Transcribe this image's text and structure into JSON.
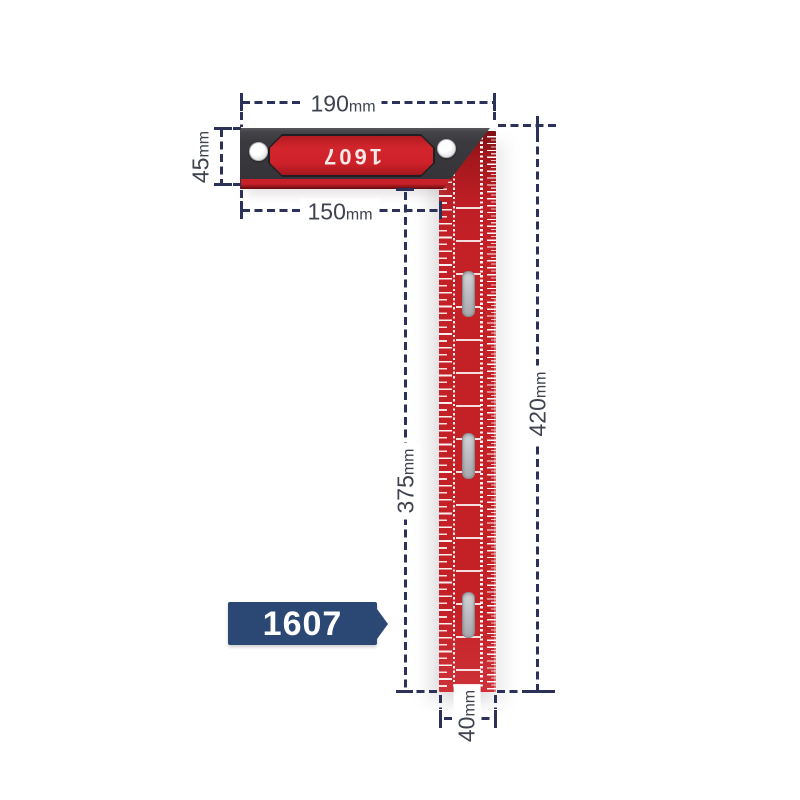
{
  "product": {
    "handle_label": "1607",
    "badge_label": "1607"
  },
  "dimensions": {
    "top_width": {
      "value": "190",
      "unit": "mm"
    },
    "handle_height": {
      "value": "45",
      "unit": "mm"
    },
    "handle_length": {
      "value": "150",
      "unit": "mm"
    },
    "blade_length": {
      "value": "375",
      "unit": "mm"
    },
    "total_length": {
      "value": "420",
      "unit": "mm"
    },
    "blade_width": {
      "value": "40",
      "unit": "mm"
    }
  },
  "colors": {
    "dimension_line": "#2b3158",
    "dimension_text": "#3f4350",
    "blade_red": "#c42127",
    "handle_dark": "#3b3b3f",
    "handle_inset_red": "#d2252c",
    "badge_navy": "#2b4874",
    "slot_silver": "#b5b6bb",
    "background": "#ffffff"
  }
}
